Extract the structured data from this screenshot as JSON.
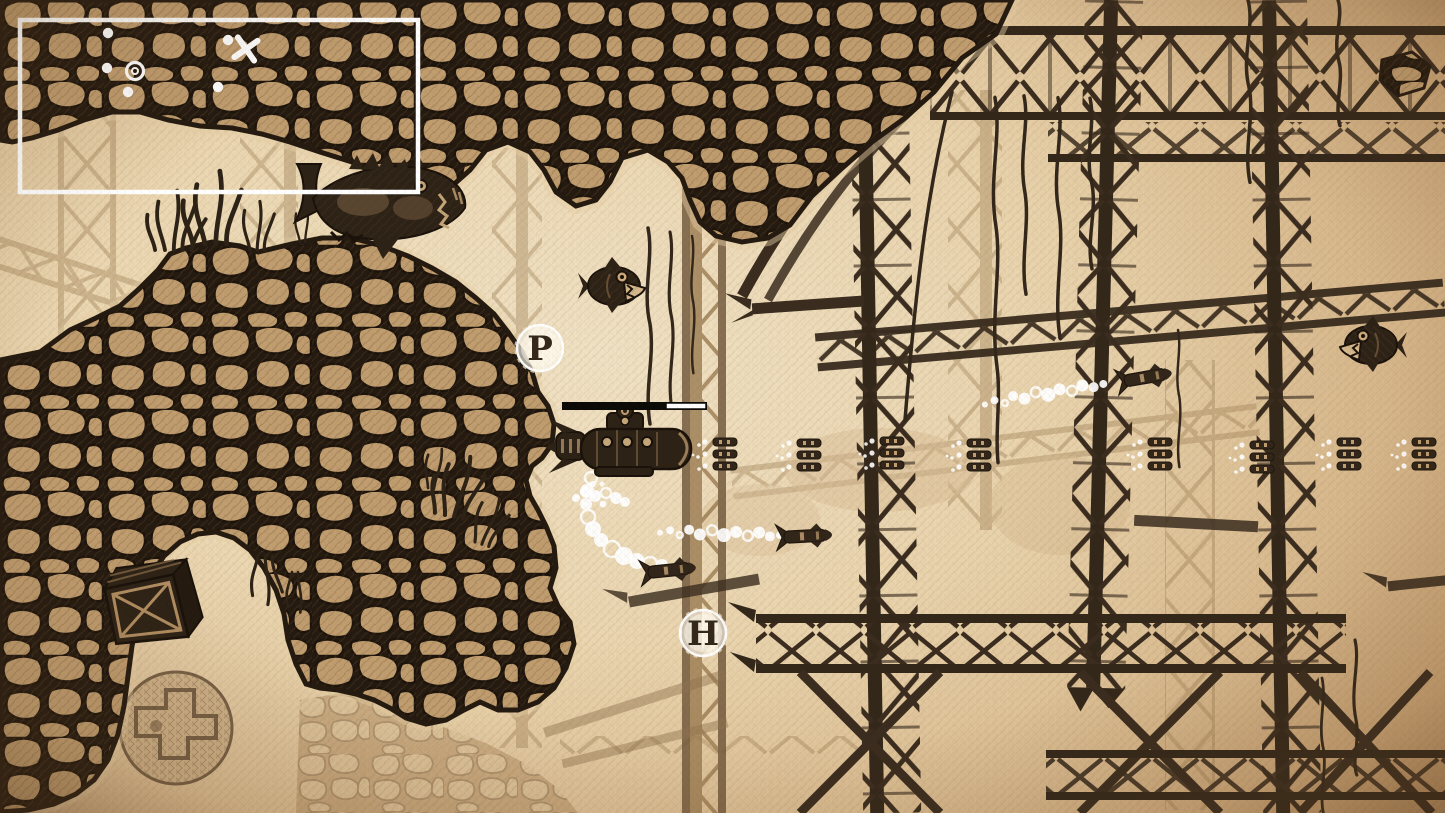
{
  "hud": {
    "minimap": {
      "frame": {
        "x": 20,
        "y": 20,
        "width": 398,
        "height": 172
      },
      "dots": [
        {
          "x": 108,
          "y": 33
        },
        {
          "x": 107,
          "y": 68
        },
        {
          "x": 128,
          "y": 92
        },
        {
          "x": 218,
          "y": 87
        },
        {
          "x": 228,
          "y": 40
        }
      ],
      "player_ring": {
        "x": 135,
        "y": 71
      },
      "target_cross": {
        "x": 246,
        "y": 49
      }
    },
    "boss_bar": {
      "track": {
        "x": 562,
        "y": 402,
        "width": 145,
        "height": 8
      },
      "segment": {
        "x": 666,
        "y": 403,
        "width": 40,
        "height": 6
      },
      "remaining_fraction": 0.27
    },
    "pickups": [
      {
        "label": "P",
        "x": 540,
        "y": 348
      },
      {
        "label": "H",
        "x": 703,
        "y": 633
      }
    ]
  },
  "entities": {
    "player": {
      "x": 623,
      "y": 447
    },
    "enemies": [
      {
        "type": "mechanical-shark",
        "x": 383,
        "y": 202
      },
      {
        "type": "piranha",
        "x": 614,
        "y": 286
      },
      {
        "type": "piranha",
        "x": 1371,
        "y": 345,
        "sx": -1
      }
    ],
    "bullet_volleys": [
      {
        "x": 721,
        "y": 454
      },
      {
        "x": 805,
        "y": 455
      },
      {
        "x": 888,
        "y": 453
      },
      {
        "x": 975,
        "y": 455
      },
      {
        "x": 1156,
        "y": 454
      },
      {
        "x": 1258,
        "y": 457
      },
      {
        "x": 1345,
        "y": 454
      },
      {
        "x": 1420,
        "y": 454
      }
    ],
    "torpedoes": [
      {
        "x": 672,
        "y": 570,
        "rot": -6
      },
      {
        "x": 808,
        "y": 536,
        "rot": -3
      },
      {
        "x": 1148,
        "y": 377,
        "rot": -10
      }
    ],
    "bubble_trails": [
      {
        "x": 722,
        "y": 533,
        "rot": 4
      },
      {
        "x": 1046,
        "y": 393,
        "rot": -7
      }
    ],
    "bubble_arcs": [
      {
        "x": 618,
        "y": 518
      }
    ],
    "bubble_puffs": [
      {
        "x": 585,
        "y": 492
      }
    ],
    "crate": {
      "x": 150,
      "y": 610,
      "rot": -12
    }
  },
  "colors": {
    "paper": "#ecd9b4",
    "ink": "#2d2216",
    "stone": "#c09d6f",
    "bar_black": "#0c0a07",
    "hud_white": "#ffffff"
  }
}
